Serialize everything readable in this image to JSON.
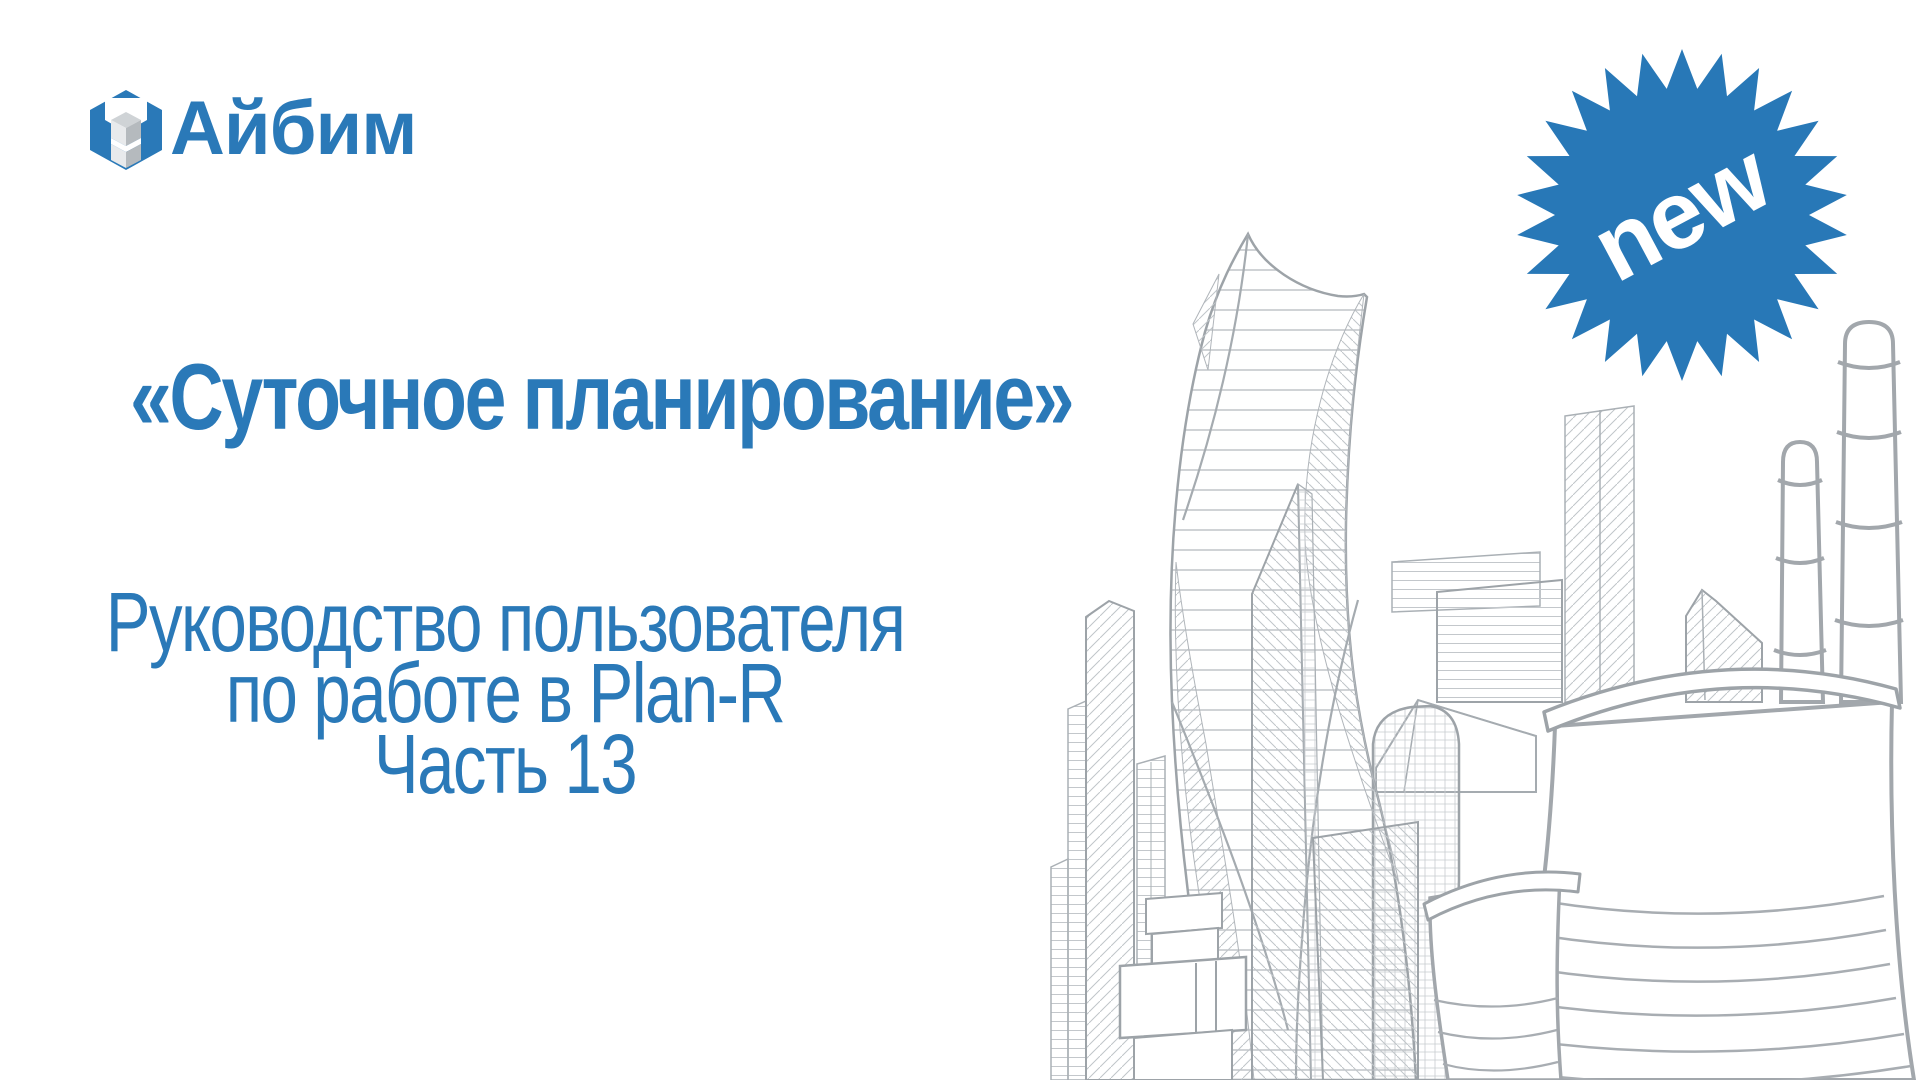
{
  "page": {
    "background": "#ffffff"
  },
  "logo": {
    "text": "Айбим",
    "icon": "aibim-cube-logo",
    "color": "#2a79b8"
  },
  "badge": {
    "label": "new",
    "fill": "#2878b7",
    "label_color": "#ffffff",
    "spikes": 26
  },
  "heading": {
    "title": "«Суточное планирование»"
  },
  "subtitle": {
    "line1": "Руководство пользователя",
    "line2": "по работе в Plan-R",
    "line3": "Часть 13"
  },
  "illustration": {
    "name": "moscow-city-towers-and-power-plant-line-art",
    "stroke": "#a6acb1",
    "hatch": "#c3c7cb"
  }
}
